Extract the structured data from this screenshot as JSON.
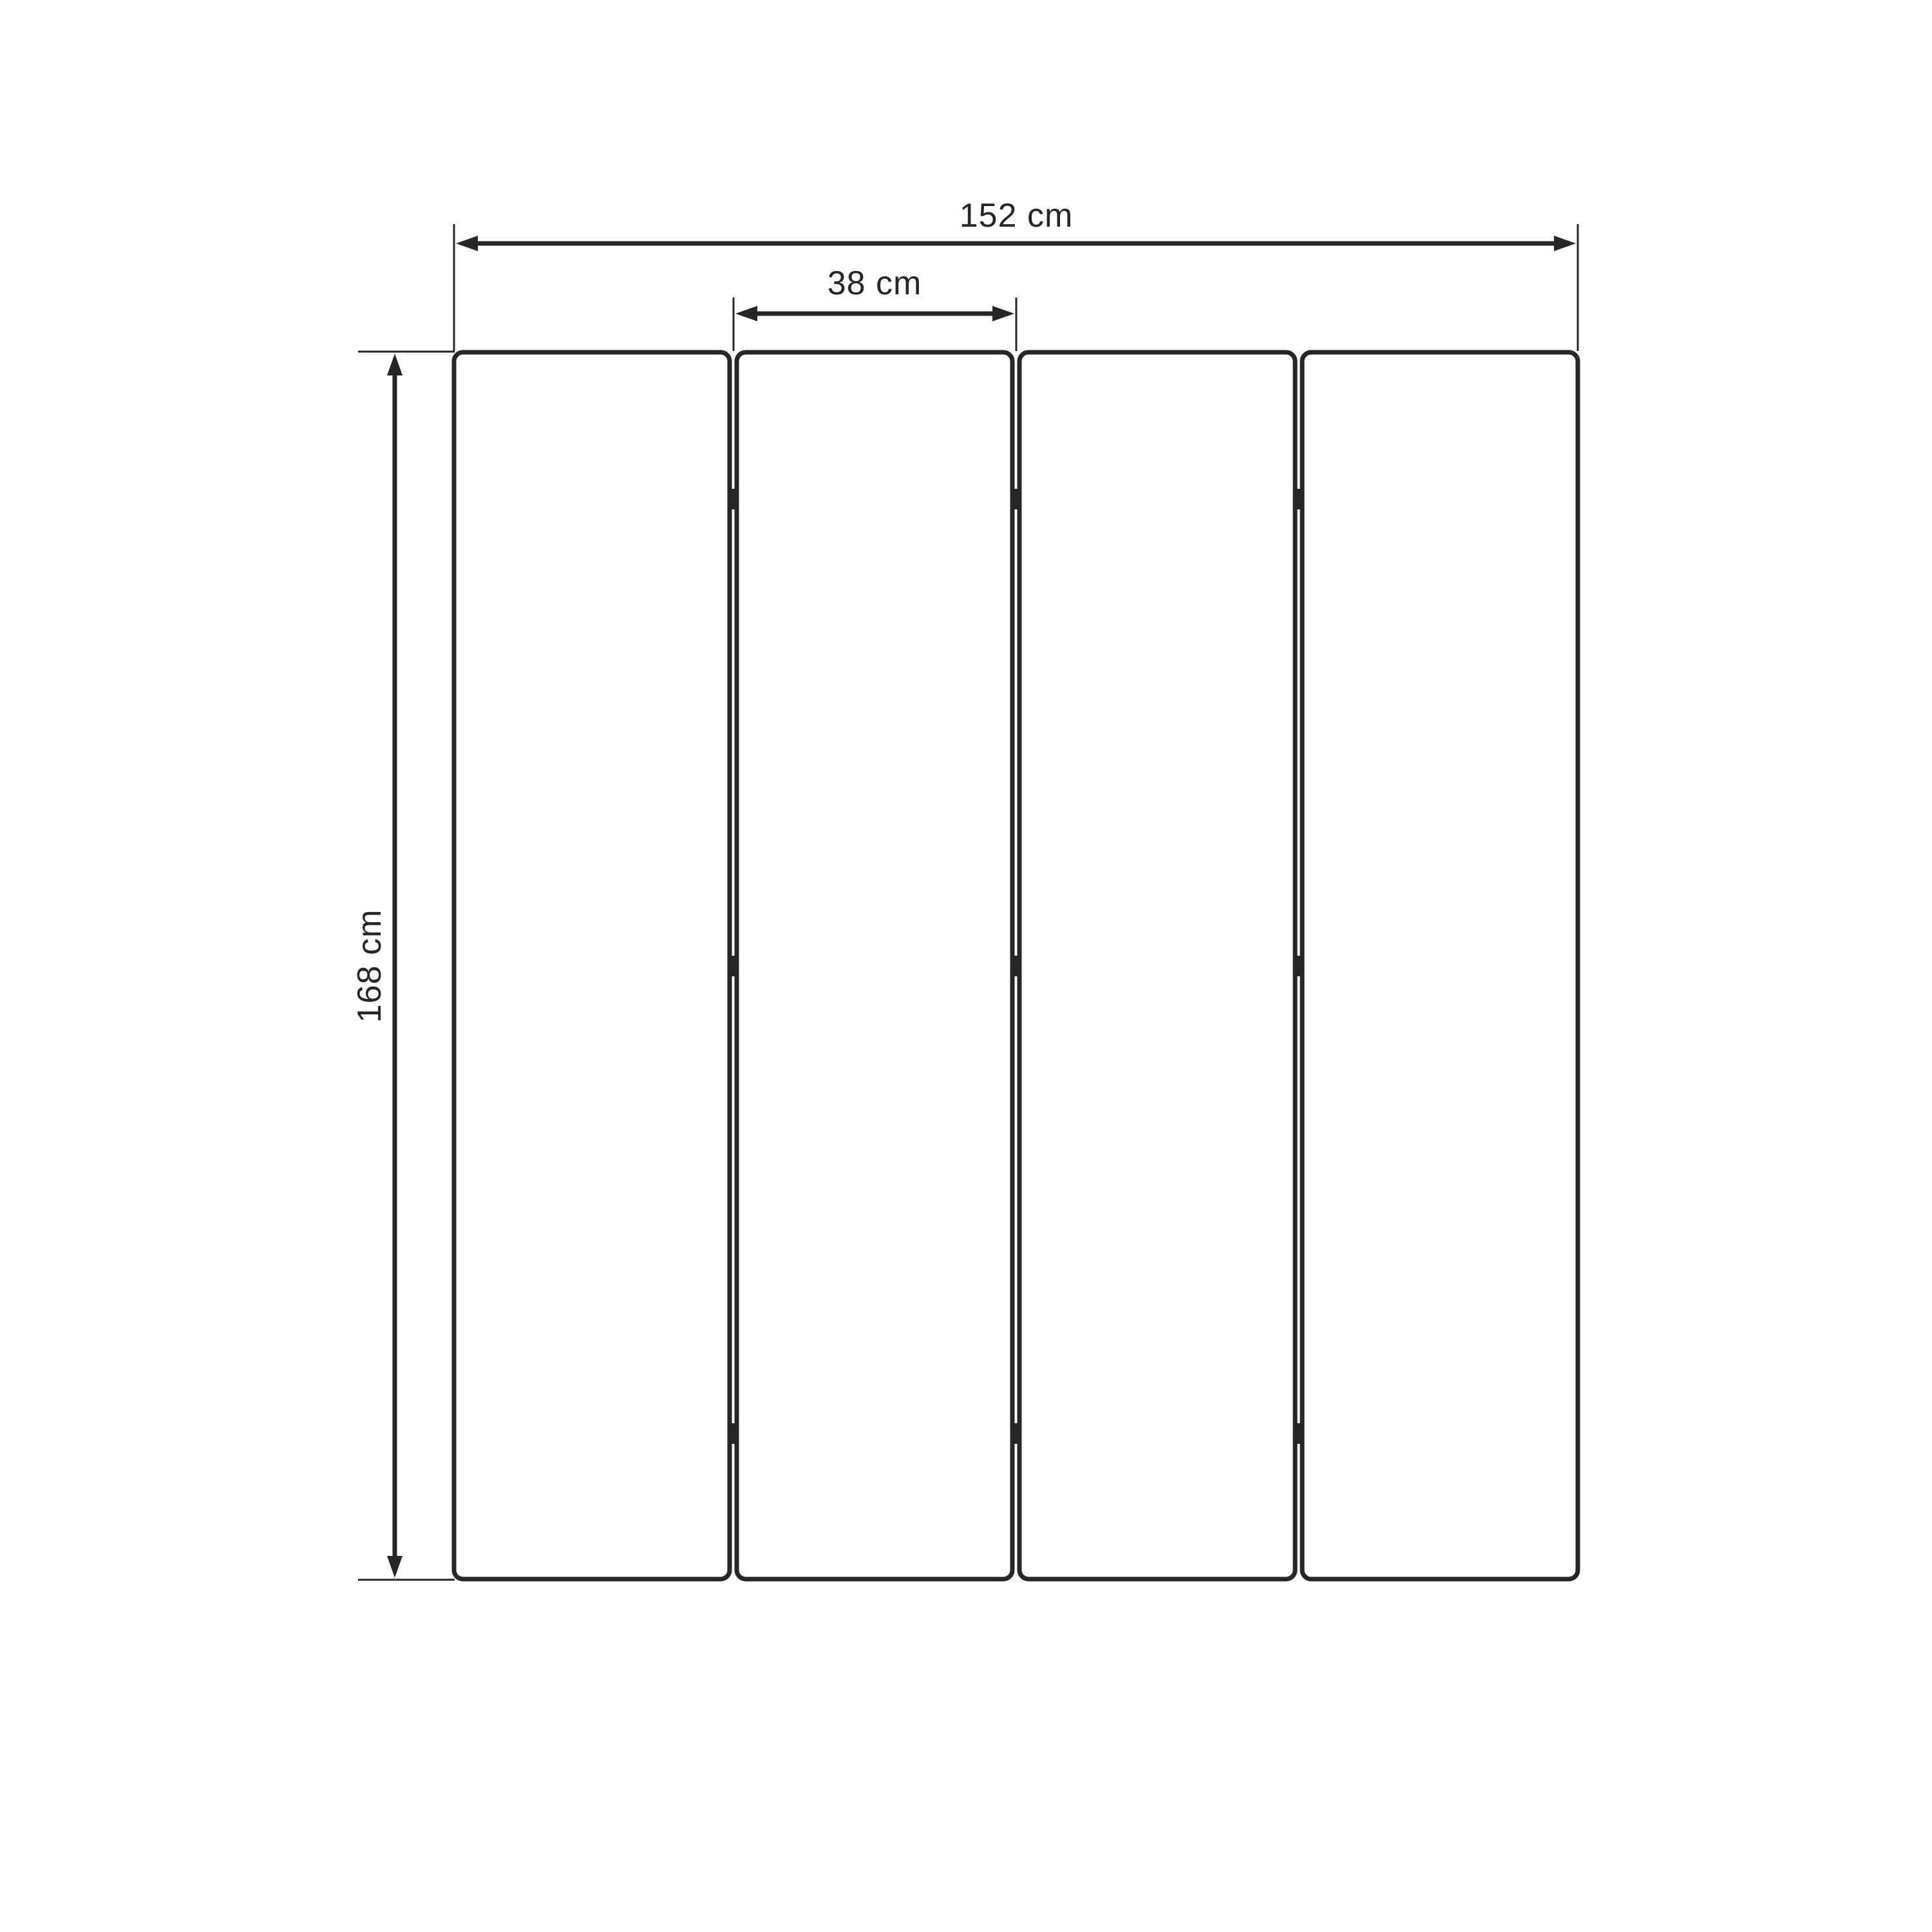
{
  "diagram": {
    "type_label": "panel-dimension-drawing",
    "dimensions": {
      "overall_width": {
        "label": "152 cm",
        "value": 152,
        "unit": "cm"
      },
      "panel_width": {
        "label": "38 cm",
        "value": 38,
        "unit": "cm"
      },
      "height": {
        "label": "168 cm",
        "value": 168,
        "unit": "cm"
      }
    },
    "panel_count": 4,
    "hinge_rows": 3,
    "colors": {
      "line": "#262626",
      "background": "#ffffff"
    }
  }
}
